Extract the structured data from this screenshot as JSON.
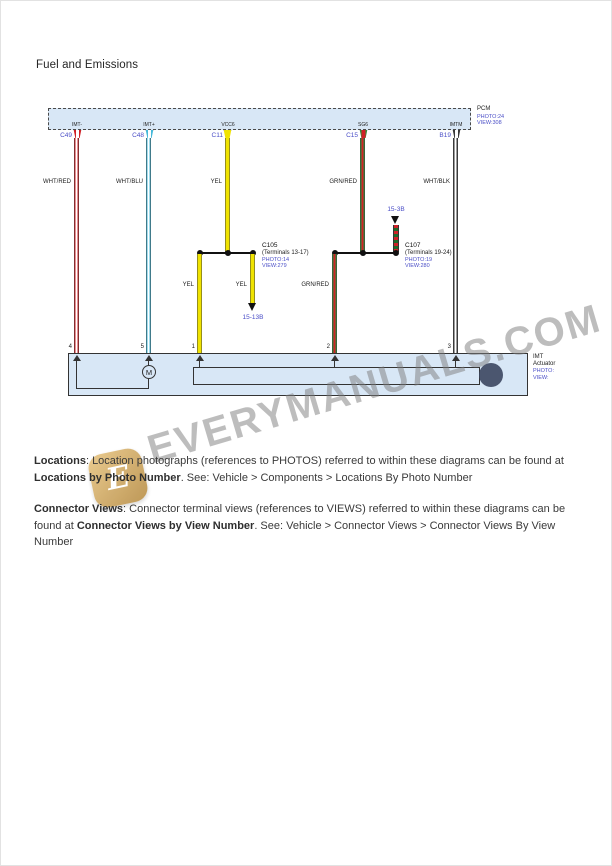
{
  "page": {
    "title": "Fuel and Emissions"
  },
  "watermark": {
    "text": "EVERYMANUALS.COM",
    "logo_letter": "E"
  },
  "diagram": {
    "pcm": {
      "name": "PCM",
      "photo": "PHOTO:24",
      "view": "VIEW:308",
      "pins": [
        {
          "signal": "IMT-",
          "connector": "C49",
          "wire": "WHT/RED"
        },
        {
          "signal": "IMT+",
          "connector": "C48",
          "wire": "WHT/BLU"
        },
        {
          "signal": "VCC6",
          "connector": "C11",
          "wire": "YEL"
        },
        {
          "signal": "SG6",
          "connector": "C15",
          "wire": "GRN/RED"
        },
        {
          "signal": "IMTM",
          "connector": "B19",
          "wire": "WHT/BLK"
        }
      ]
    },
    "junction_left": {
      "connector": "C105",
      "terminals": "(Terminals 13-17)",
      "photo": "PHOTO:14",
      "view": "VIEW:279",
      "branch_to_actuator": "YEL",
      "branch_to_ref": "YEL",
      "page_ref": "15-13B"
    },
    "junction_right": {
      "connector": "C107",
      "terminals": "(Terminals 19-24)",
      "photo": "PHOTO:19",
      "view": "VIEW:280",
      "branch_to_actuator": "GRN/RED",
      "page_ref": "15-3B"
    },
    "actuator": {
      "name_line1": "IMT",
      "name_line2": "Actuator",
      "photo": "PHOTO:",
      "view": "VIEW:",
      "motor": "M",
      "pin_numbers": [
        "4",
        "5",
        "1",
        "2",
        "3"
      ]
    }
  },
  "notes": [
    {
      "segments": [
        {
          "bold": true,
          "text": "Locations"
        },
        {
          "bold": false,
          "text": ": Location photographs (references to PHOTOS) referred to within these diagrams can be found at "
        },
        {
          "bold": true,
          "text": "Locations by Photo Number"
        },
        {
          "bold": false,
          "text": ". See: Vehicle > Components > Locations By Photo Number"
        }
      ]
    },
    {
      "segments": [
        {
          "bold": true,
          "text": "Connector Views"
        },
        {
          "bold": false,
          "text": ": Connector terminal views (references to VIEWS) referred to within these diagrams can be found at "
        },
        {
          "bold": true,
          "text": "Connector Views by View Number"
        },
        {
          "bold": false,
          "text": ". See: Vehicle > Connector Views > Connector Views By View Number"
        }
      ]
    }
  ],
  "colors": {
    "ref-blue": "#4a4ec7",
    "box-fill": "#d8e7f6",
    "wire-red": "#cf2127",
    "wire-blue": "#45b9da",
    "wire-yellow": "#f0e300",
    "wire-green": "#2f8f3a",
    "wire-dark": "#3a3a3a",
    "watermark-gray": "#7d7d7d",
    "watermark-gold": "#b9904a"
  }
}
